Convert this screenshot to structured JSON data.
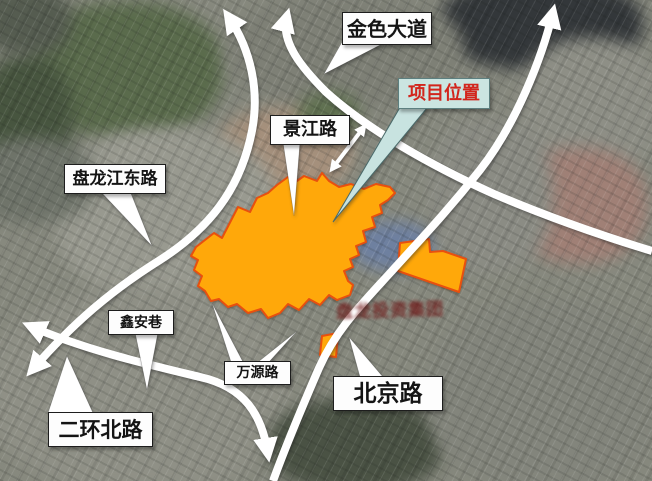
{
  "figure": {
    "kind": "satellite-location-map",
    "width_px": 652,
    "height_px": 481
  },
  "callouts": {
    "jinse_dadao": "金色大道",
    "jingjiang_lu": "景江路",
    "panlongjiang_donglu": "盘龙江东路",
    "xinan_xiang": "鑫安巷",
    "wanyuan_lu": "万源路",
    "beijing_lu": "北京路",
    "erhuan_beilu": "二环北路"
  },
  "project": {
    "label": "项目位置",
    "label_text_color": "#d2251c",
    "label_box_color": "#cbe5e1",
    "site_fill_color": "#ffa80a",
    "site_border_color": "#e8500f",
    "parcel_count": 3
  },
  "watermark": {
    "text": "盘龙投资集团",
    "color": "#6e1010"
  }
}
